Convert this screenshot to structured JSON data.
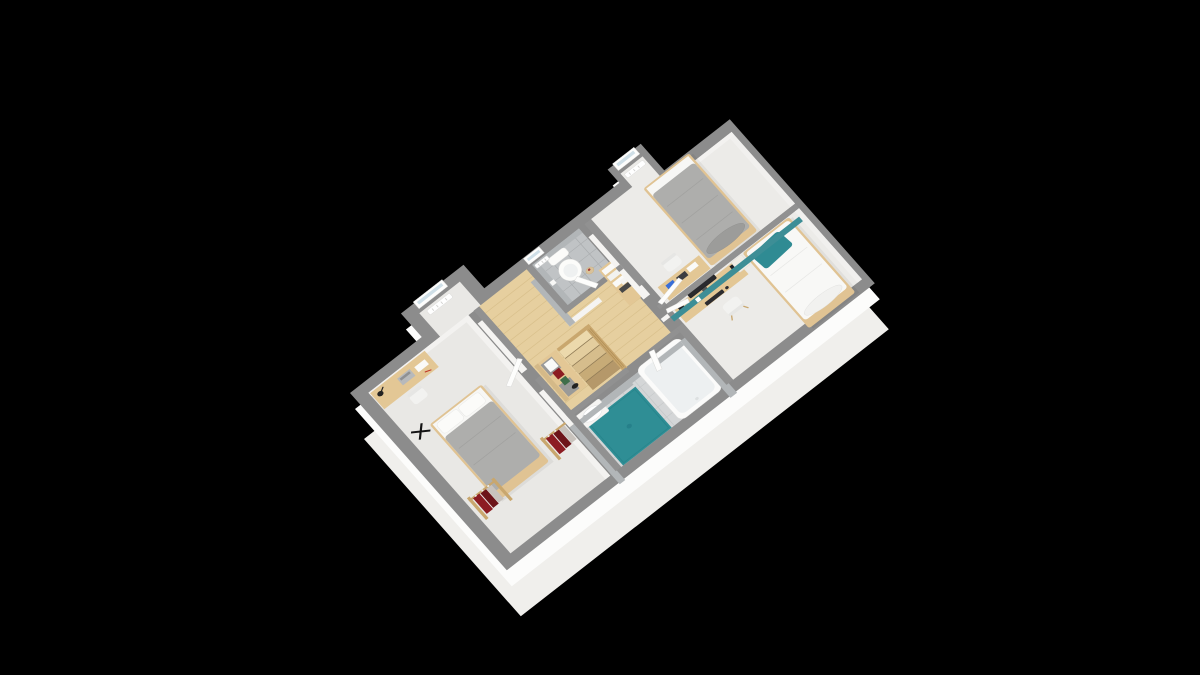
{
  "scene": {
    "title": "Isometric 3D floor plan render of an upper storey, dollhouse cutaway view on a black background",
    "background": "#000000",
    "view": "axonometric from the south-east, walls cut at waist height"
  },
  "palette": {
    "background": "#000000",
    "wall_top": "#8c8c8c",
    "wall_top_inner": "#919191",
    "wall_face": "#f5f4f2",
    "skirt": "#f0efec",
    "skirt_face": "#fcfcfb",
    "carpet": "#e9e8e5",
    "carpet_b": "#ecebe8",
    "wood_floor": "#e6cf9f",
    "plank": "#d9c08c",
    "tile_wc": "#c0c3c5",
    "tile_bath": "#d4d6d7",
    "tile_wall": "#b2b6b8",
    "teal_wall": "#3d8e96",
    "teal_pillow": "#2f8b93",
    "shower": "#2f8e95",
    "wood": "#e3c795",
    "wood_dark": "#c9a76e",
    "duvet_gray": "#aeaeac",
    "linen_white": "#f8f8f6",
    "clothes_red": "#8c1c22",
    "clothes_red_dark": "#6d1419",
    "device_dark": "#2a2a2e",
    "accent_blue": "#3a6fd8",
    "chair_white": "#f2f2f0",
    "radiator": "#ffffff",
    "glass": "#cfdfe7",
    "door_leaf": "#fdfdfc"
  },
  "rooms": [
    {
      "id": "bedroom-sw",
      "name": "bedroom south-west",
      "floor": "light gray carpet",
      "furniture": [
        "double bed, gray duvet, two white pillows, wooden base",
        "wooden desk with black lamp, laptop and papers",
        "white desk chair",
        "black folding stand on floor",
        "clothes rack with dark red garments (x2)"
      ],
      "window": true,
      "radiator": true
    },
    {
      "id": "landing",
      "name": "landing with staircase",
      "floor": "light wood planks",
      "furniture": [
        "staircase descending south-east with wooden balustrade",
        "wooden sideboard with gray panels, colored books on top",
        "wooden cabinet with white box files",
        "basket with flowers"
      ]
    },
    {
      "id": "wc",
      "name": "toilet room",
      "floor": "gray tile, gray tiled walls",
      "furniture": [
        "toilet with cistern",
        "toilet paper holder"
      ],
      "window": true,
      "radiator": true
    },
    {
      "id": "bathroom",
      "name": "bathroom",
      "floor": "pale tile, gray tiled walls",
      "furniture": [
        "bathtub with chrome faucet",
        "teal walk-in shower floor",
        "white washbasin on cabinet"
      ]
    },
    {
      "id": "bedroom-n",
      "name": "bedroom north",
      "floor": "light gray carpet",
      "accent": "teal headboard partition wall",
      "furniture": [
        "single bed, gray duvet, gray bolster pillow",
        "wooden desk with blue box, dark tablet, papers",
        "white chair",
        "wooden cabinet against hall wall"
      ],
      "window": true,
      "radiator": true
    },
    {
      "id": "bedroom-e",
      "name": "bedroom east",
      "floor": "light gray carpet",
      "furniture": [
        "single bed, white duvet, teal pillow, white bolster",
        "wooden desk with dark monitor, keyboard, speaker, lamp",
        "white chair",
        "white nightstand"
      ]
    }
  ],
  "openings": {
    "window_count": 3,
    "windows": [
      "bay window bedroom south-west",
      "bay window bedroom north",
      "small window toilet room"
    ],
    "door_count": 5,
    "doors": [
      "bedroom south-west",
      "toilet room",
      "bathroom",
      "bedroom north",
      "bedroom east"
    ]
  },
  "stairs": {
    "visible_treads": 5,
    "balustrade": "wooden balusters on north-east side",
    "direction": "descending toward south-east"
  }
}
